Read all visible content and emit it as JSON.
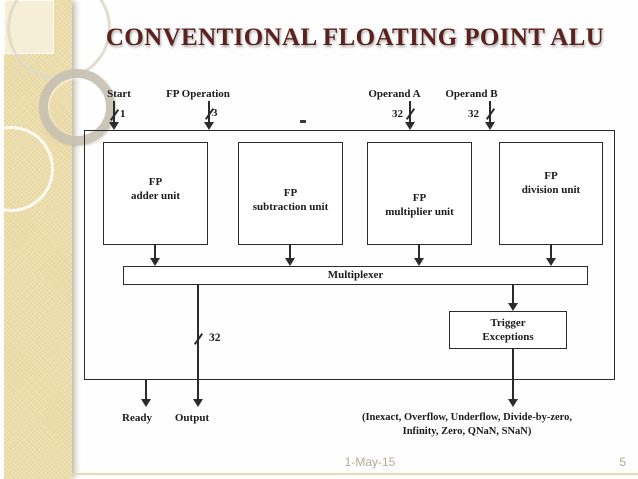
{
  "title": "CONVENTIONAL FLOATING POINT ALU",
  "diagram": {
    "inputs": {
      "start": {
        "label": "Start",
        "width": "1"
      },
      "operation": {
        "label": "FP Operation",
        "width": "3"
      },
      "operand_a": {
        "label": "Operand A",
        "width": "32"
      },
      "operand_b": {
        "label": "Operand B",
        "width": "32"
      }
    },
    "units": {
      "adder": {
        "line1": "FP",
        "line2": "adder unit"
      },
      "subtraction": {
        "line1": "FP",
        "line2": "subtraction unit"
      },
      "multiplier": {
        "line1": "FP",
        "line2": "multiplier unit"
      },
      "division": {
        "line1": "FP",
        "line2": "division unit"
      }
    },
    "multiplexer_label": "Multiplexer",
    "trigger": {
      "line1": "Trigger",
      "line2": "Exceptions"
    },
    "output_bus_width": "32",
    "outputs": {
      "ready": "Ready",
      "output": "Output"
    },
    "exceptions": {
      "line1": "(Inexact, Overflow, Underflow, Divide-by-zero,",
      "line2": "Infinity, Zero, QNaN, SNaN)"
    }
  },
  "footer": {
    "date": "1-May-15",
    "page_number": "5"
  },
  "colors": {
    "title_text": "#5b211c",
    "diagram_line": "#2b2b2b",
    "sidebar_beige": "#ecdca8",
    "footer_text": "#b3aa96"
  }
}
